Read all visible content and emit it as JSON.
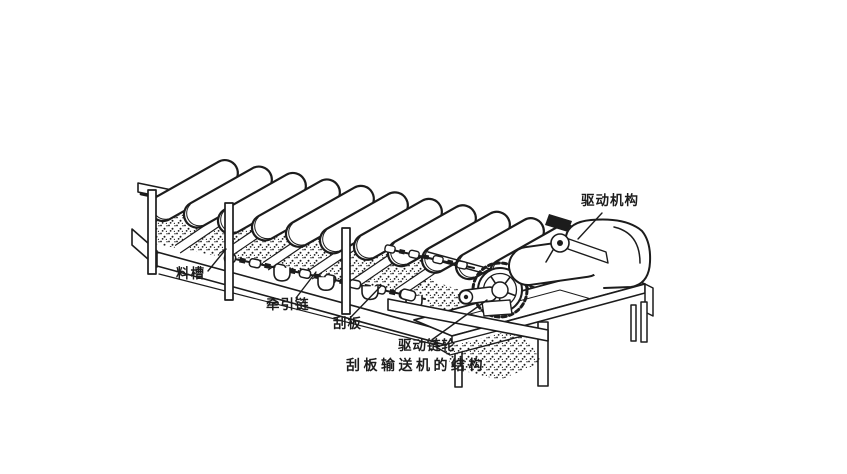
{
  "figure": {
    "caption": "刮板输送机的结构",
    "labels": {
      "drive_mechanism": "驱动机构",
      "trough": "料槽",
      "traction_chain": "牵引链",
      "scraper": "刮板",
      "drive_sprocket": "驱动链轮"
    },
    "colors": {
      "ink": "#1c1c1c",
      "far_ink": "#8e8e8e",
      "paper": "#ffffff"
    }
  }
}
